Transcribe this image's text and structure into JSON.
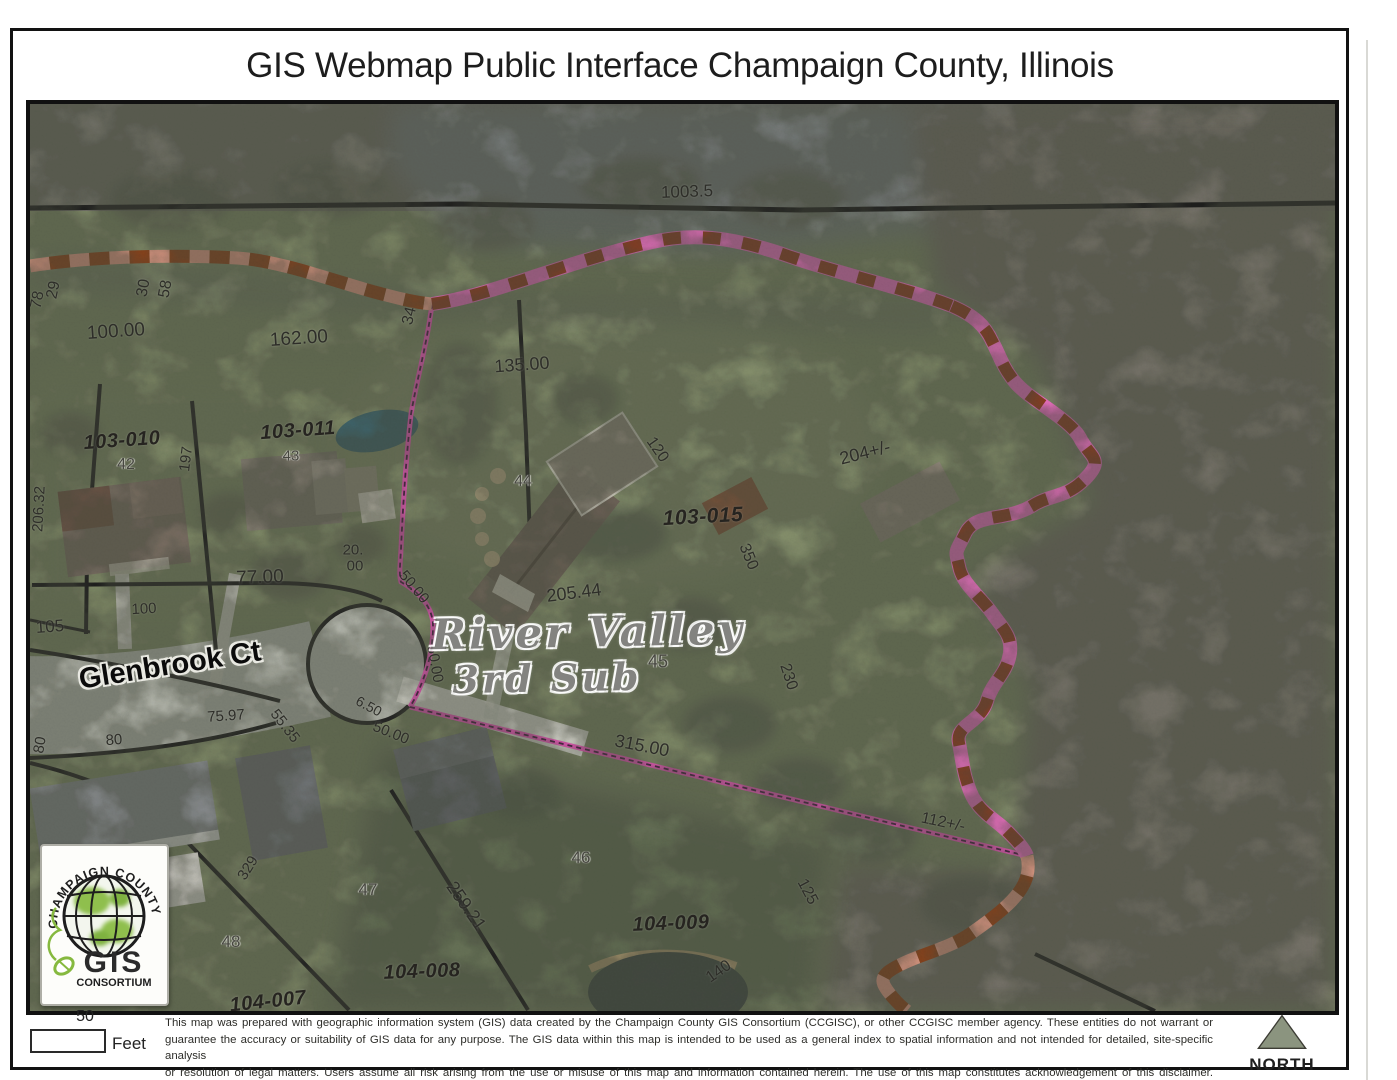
{
  "page": {
    "title": "GIS Webmap Public Interface Champaign County, Illinois"
  },
  "map": {
    "labels": [
      {
        "t": "1003.5",
        "x": 657,
        "y": 88,
        "r": -2,
        "s": 17,
        "c": "dim"
      },
      {
        "t": "29",
        "x": 24,
        "y": 186,
        "r": -78,
        "s": 16,
        "c": "dim"
      },
      {
        "t": "78",
        "x": 8,
        "y": 196,
        "r": -78,
        "s": 16,
        "c": "dim"
      },
      {
        "t": "30",
        "x": 114,
        "y": 184,
        "r": -80,
        "s": 16,
        "c": "dim"
      },
      {
        "t": "58",
        "x": 136,
        "y": 185,
        "r": -80,
        "s": 16,
        "c": "dim"
      },
      {
        "t": "100.00",
        "x": 86,
        "y": 228,
        "r": -4,
        "s": 19,
        "c": "dim"
      },
      {
        "t": "162.00",
        "x": 269,
        "y": 235,
        "r": -4,
        "s": 19,
        "c": "dim"
      },
      {
        "t": "34",
        "x": 380,
        "y": 212,
        "r": -76,
        "s": 16,
        "c": "dim"
      },
      {
        "t": "135.00",
        "x": 492,
        "y": 261,
        "r": -4,
        "s": 18,
        "c": "dim"
      },
      {
        "t": "103-010",
        "x": 92,
        "y": 337,
        "r": -4,
        "s": 20,
        "c": "parcel"
      },
      {
        "t": "42",
        "x": 96,
        "y": 361,
        "r": 0,
        "s": 16,
        "c": "lot"
      },
      {
        "t": "197",
        "x": 156,
        "y": 355,
        "r": -83,
        "s": 15,
        "c": "dim"
      },
      {
        "t": "206.32",
        "x": 9,
        "y": 405,
        "r": -87,
        "s": 15,
        "c": "dim"
      },
      {
        "t": "103-011",
        "x": 268,
        "y": 327,
        "r": -4,
        "s": 20,
        "c": "parcel"
      },
      {
        "t": "43",
        "x": 261,
        "y": 352,
        "r": 0,
        "s": 15,
        "c": "lot"
      },
      {
        "t": "44",
        "x": 493,
        "y": 378,
        "r": 0,
        "s": 16,
        "c": "lot"
      },
      {
        "t": "120",
        "x": 627,
        "y": 346,
        "r": 55,
        "s": 16,
        "c": "dim"
      },
      {
        "t": "103-015",
        "x": 673,
        "y": 413,
        "r": -3,
        "s": 21,
        "c": "parcel"
      },
      {
        "t": "204+/-",
        "x": 835,
        "y": 349,
        "r": -14,
        "s": 18,
        "c": "dim"
      },
      {
        "t": "350",
        "x": 718,
        "y": 453,
        "r": 68,
        "s": 16,
        "c": "dim"
      },
      {
        "t": "205.44",
        "x": 544,
        "y": 489,
        "r": -7,
        "s": 18,
        "c": "dim"
      },
      {
        "t": "45",
        "x": 628,
        "y": 558,
        "r": 0,
        "s": 18,
        "c": "lot"
      },
      {
        "t": "230",
        "x": 758,
        "y": 573,
        "r": 72,
        "s": 16,
        "c": "dim"
      },
      {
        "t": "20.",
        "x": 323,
        "y": 446,
        "r": 0,
        "s": 15,
        "c": "dim"
      },
      {
        "t": "00",
        "x": 325,
        "y": 462,
        "r": 0,
        "s": 15,
        "c": "dim"
      },
      {
        "t": "50.00",
        "x": 384,
        "y": 483,
        "r": 50,
        "s": 15,
        "c": "dim"
      },
      {
        "t": "77.00",
        "x": 230,
        "y": 474,
        "r": -2,
        "s": 19,
        "c": "dim"
      },
      {
        "t": "105",
        "x": 20,
        "y": 523,
        "r": -4,
        "s": 17,
        "c": "dim"
      },
      {
        "t": "100",
        "x": 114,
        "y": 505,
        "r": -3,
        "s": 15,
        "c": "dim"
      },
      {
        "t": "Glenbrook Ct",
        "x": 140,
        "y": 562,
        "r": -9,
        "s": 29,
        "c": "street"
      },
      {
        "t": "80",
        "x": 10,
        "y": 641,
        "r": -80,
        "s": 15,
        "c": "dim"
      },
      {
        "t": "80",
        "x": 84,
        "y": 636,
        "r": -4,
        "s": 15,
        "c": "dim"
      },
      {
        "t": "75.97",
        "x": 196,
        "y": 612,
        "r": -4,
        "s": 15,
        "c": "dim"
      },
      {
        "t": "55.35",
        "x": 255,
        "y": 622,
        "r": 52,
        "s": 15,
        "c": "dim"
      },
      {
        "t": "6.50",
        "x": 339,
        "y": 602,
        "r": 28,
        "s": 14,
        "c": "dim"
      },
      {
        "t": "50.00",
        "x": 361,
        "y": 629,
        "r": 22,
        "s": 15,
        "c": "dim"
      },
      {
        "t": "50.00",
        "x": 405,
        "y": 560,
        "r": 80,
        "s": 15,
        "c": "dim"
      },
      {
        "t": "315.00",
        "x": 612,
        "y": 642,
        "r": 11,
        "s": 18,
        "c": "dim"
      },
      {
        "t": "112+/-",
        "x": 913,
        "y": 719,
        "r": 12,
        "s": 16,
        "c": "dim"
      },
      {
        "t": "River Valley",
        "x": 558,
        "y": 528,
        "r": -1,
        "s": 42,
        "c": "watermark"
      },
      {
        "t": "3rd Sub",
        "x": 517,
        "y": 574,
        "r": -1,
        "s": 38,
        "c": "watermark"
      },
      {
        "t": "46",
        "x": 551,
        "y": 754,
        "r": 0,
        "s": 17,
        "c": "lot"
      },
      {
        "t": "329",
        "x": 218,
        "y": 764,
        "r": -58,
        "s": 15,
        "c": "dim"
      },
      {
        "t": "47",
        "x": 338,
        "y": 786,
        "r": 0,
        "s": 17,
        "c": "lot"
      },
      {
        "t": "259.21",
        "x": 436,
        "y": 802,
        "r": 55,
        "s": 18,
        "c": "dim"
      },
      {
        "t": "48",
        "x": 201,
        "y": 838,
        "r": 0,
        "s": 17,
        "c": "lot"
      },
      {
        "t": "104-008",
        "x": 392,
        "y": 868,
        "r": -2,
        "s": 20,
        "c": "parcel"
      },
      {
        "t": "104-007",
        "x": 238,
        "y": 898,
        "r": -6,
        "s": 20,
        "c": "parcel"
      },
      {
        "t": "104-009",
        "x": 641,
        "y": 820,
        "r": -2,
        "s": 20,
        "c": "parcel"
      },
      {
        "t": "140",
        "x": 689,
        "y": 868,
        "r": -35,
        "s": 16,
        "c": "dim"
      },
      {
        "t": "125",
        "x": 777,
        "y": 788,
        "r": 62,
        "s": 16,
        "c": "dim"
      }
    ],
    "logo": {
      "arc_text": "CHAMPAIGN COUNTY",
      "main": "GIS",
      "sub": "CONSORTIUM"
    }
  },
  "footer": {
    "scale_value": "50",
    "scale_unit": "Feet",
    "north_label": "NORTH",
    "disclaimer_lines": [
      "This map was prepared with geographic information system (GIS) data created by the Champaign County GIS Consortium (CCGISC), or other CCGISC member agency. These entities do not warrant or",
      "guarantee the accuracy or suitability of GIS data for any purpose. The GIS data within this map is intended to be used as a general index to spatial information and not intended for detailed, site-specific analysis",
      "or resolution of legal matters. Users assume all risk arising from the use or misuse of this map and information contained herein. The use of this map constitutes acknowledgement of this disclaimer."
    ]
  },
  "colors": {
    "highlight_pink": "#f553c1",
    "stream_dark_dash": "#8a3b10",
    "stream_light_dash": "#e69a84",
    "parcel_line": "#151515",
    "logo_green": "#86b93f"
  }
}
